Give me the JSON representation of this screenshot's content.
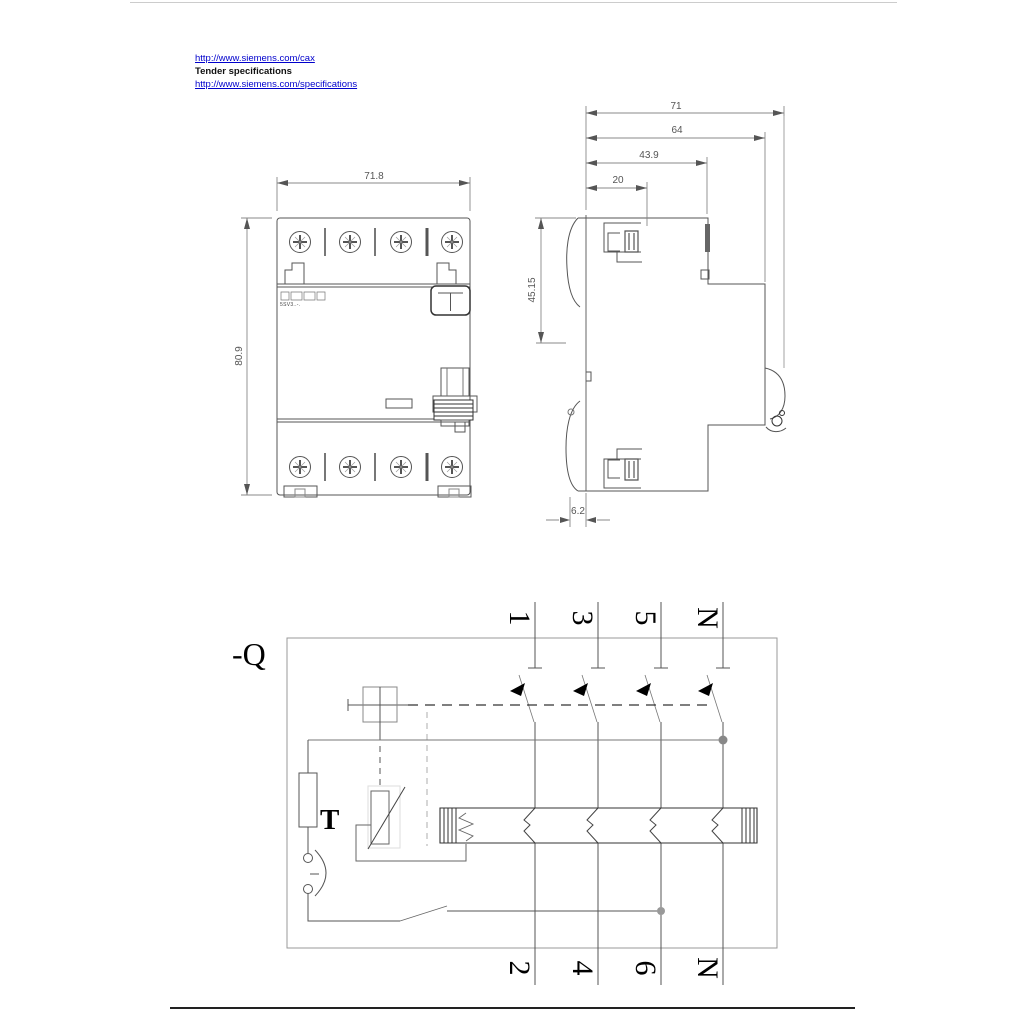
{
  "links": {
    "cax": "http://www.siemens.com/cax",
    "tender": "Tender specifications",
    "specs": "http://www.siemens.com/specifications"
  },
  "front_view": {
    "width_dim": "71.8",
    "height_dim": "80.9",
    "product_label": "5SV3..-."
  },
  "side_view": {
    "dims": [
      "71",
      "64",
      "43.9",
      "20"
    ],
    "height_upper": "45.15",
    "bottom_offset": "6.2"
  },
  "circuit": {
    "device_label": "-Q",
    "test_label": "T",
    "top_terminals": [
      "1",
      "3",
      "5",
      "N"
    ],
    "bottom_terminals": [
      "2",
      "4",
      "6",
      "N"
    ]
  },
  "colors": {
    "link": "#0000cc",
    "drawing_line": "#555555",
    "dim_line": "#888888"
  }
}
